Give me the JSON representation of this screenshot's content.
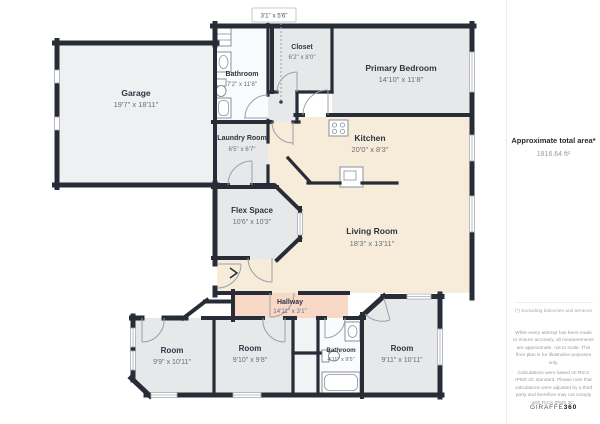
{
  "floorplan": {
    "wall_color": "#272c37",
    "fills": {
      "gray_room": "#e7e8ea",
      "garage": "#eef0f1",
      "cream": "#f6ecd9",
      "hallway_pink": "#f8d9c8",
      "white_room": "#fafbfd",
      "closet_strip": "#f2f3f5"
    },
    "top_dimension_label": "3'1\" x 5'6\"",
    "rooms": [
      {
        "name": "Garage",
        "dims": "19'7\" x 18'11\""
      },
      {
        "name": "Bathroom",
        "dims": "7'2\" x 11'8\""
      },
      {
        "name": "Closet",
        "dims": "6'2\" x 8'0\""
      },
      {
        "name": "Primary Bedroom",
        "dims": "14'10\" x 11'8\""
      },
      {
        "name": "Laundry Room",
        "dims": "6'5\" x 6'7\""
      },
      {
        "name": "Kitchen",
        "dims": "20'0\" x 8'3\""
      },
      {
        "name": "Flex Space",
        "dims": "10'6\" x 10'3\""
      },
      {
        "name": "Living Room",
        "dims": "18'3\" x 13'11\""
      },
      {
        "name": "Hallway",
        "dims": "14'11\" x 3'1\""
      },
      {
        "name": "Room",
        "dims": "9'9\" x 10'11\""
      },
      {
        "name": "Room",
        "dims": "9'10\" x 9'8\""
      },
      {
        "name": "Bathroom",
        "dims": "4'11\" x 9'5\""
      },
      {
        "name": "Room",
        "dims": "9'11\" x 10'11\""
      }
    ]
  },
  "sidebar": {
    "area_title": "Approximate total area*",
    "area_value": "1816.64 ft²",
    "footnote": "(*) Excluding balconies and terraces",
    "disclaimer1": "While every attempt has been made to ensure accuracy, all measurements are approximate, not to scale. This floor plan is for illustrative purposes only.",
    "disclaimer2": "Calculations were based on RICS IPMS 3C standard. Please note that calculations were adjusted by a third party and therefore may not comply with RICS IPMS 3C.",
    "logo_text": "GIRAFFE",
    "logo_suffix": "360"
  }
}
